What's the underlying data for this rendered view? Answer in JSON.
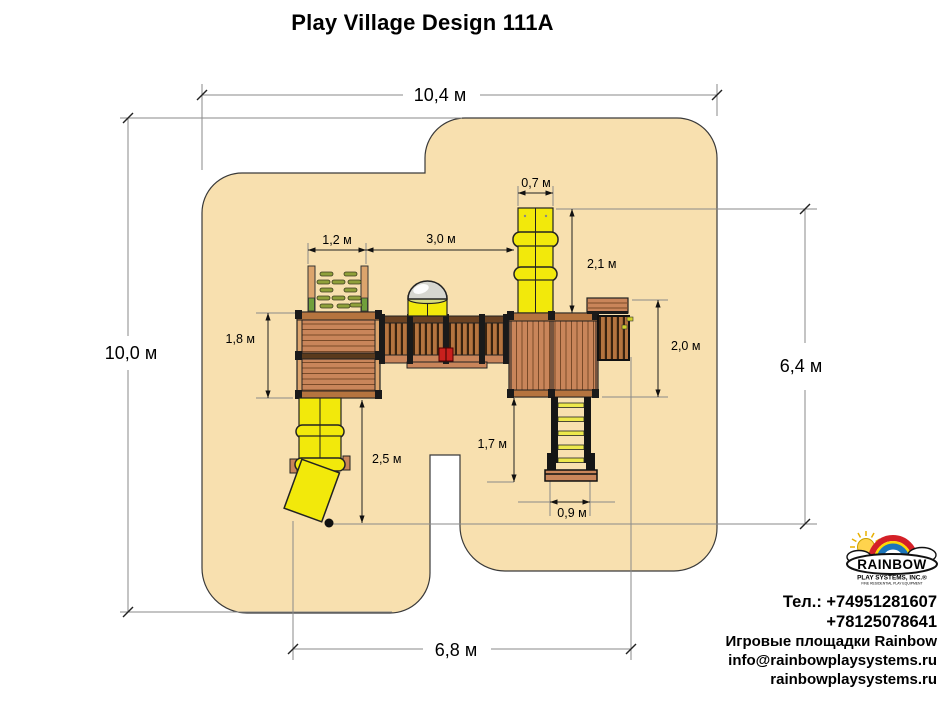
{
  "title": "Play Village Design 111A",
  "dimensions": {
    "total_width": "10,4 м",
    "total_depth": "10,0 м",
    "right_depth": "6,4 м",
    "towers_span": "6,8 м",
    "tube_width": "0,7 м",
    "rock_wall_width": "1,2 м",
    "bridge_span": "3,0 м",
    "tube_length": "2,1 м",
    "right_tower_length": "2,0 м",
    "left_tower_length": "1,8 м",
    "spiral_slide_length": "2,5 м",
    "ladder_length": "1,7 м",
    "ladder_width": "0,9 м"
  },
  "logo": {
    "brand": "RAINBOW",
    "subtitle": "PLAY SYSTEMS, INC.®",
    "tagline": "FINE RESIDENTIAL PLAY EQUIPMENT"
  },
  "contacts": {
    "phone1": "Тел.: +74951281607",
    "phone2": "+78125078641",
    "line3": "Игровые площадки Rainbow",
    "email": "info@rainbowplaysystems.ru",
    "website": "rainbowplaysystems.ru"
  },
  "colors": {
    "sand": "#F8E0AF",
    "wood": "#C9855A",
    "wood_dark": "#7a4a28",
    "wood_light": "#DCA46C",
    "frame_black": "#1a1a1a",
    "slide_yellow": "#F2E90B",
    "hold_green": "#8FA03A",
    "binocular_red": "#C8201D",
    "logo_red": "#D42027",
    "logo_yellow": "#FFD800",
    "logo_blue": "#1B75BB"
  }
}
